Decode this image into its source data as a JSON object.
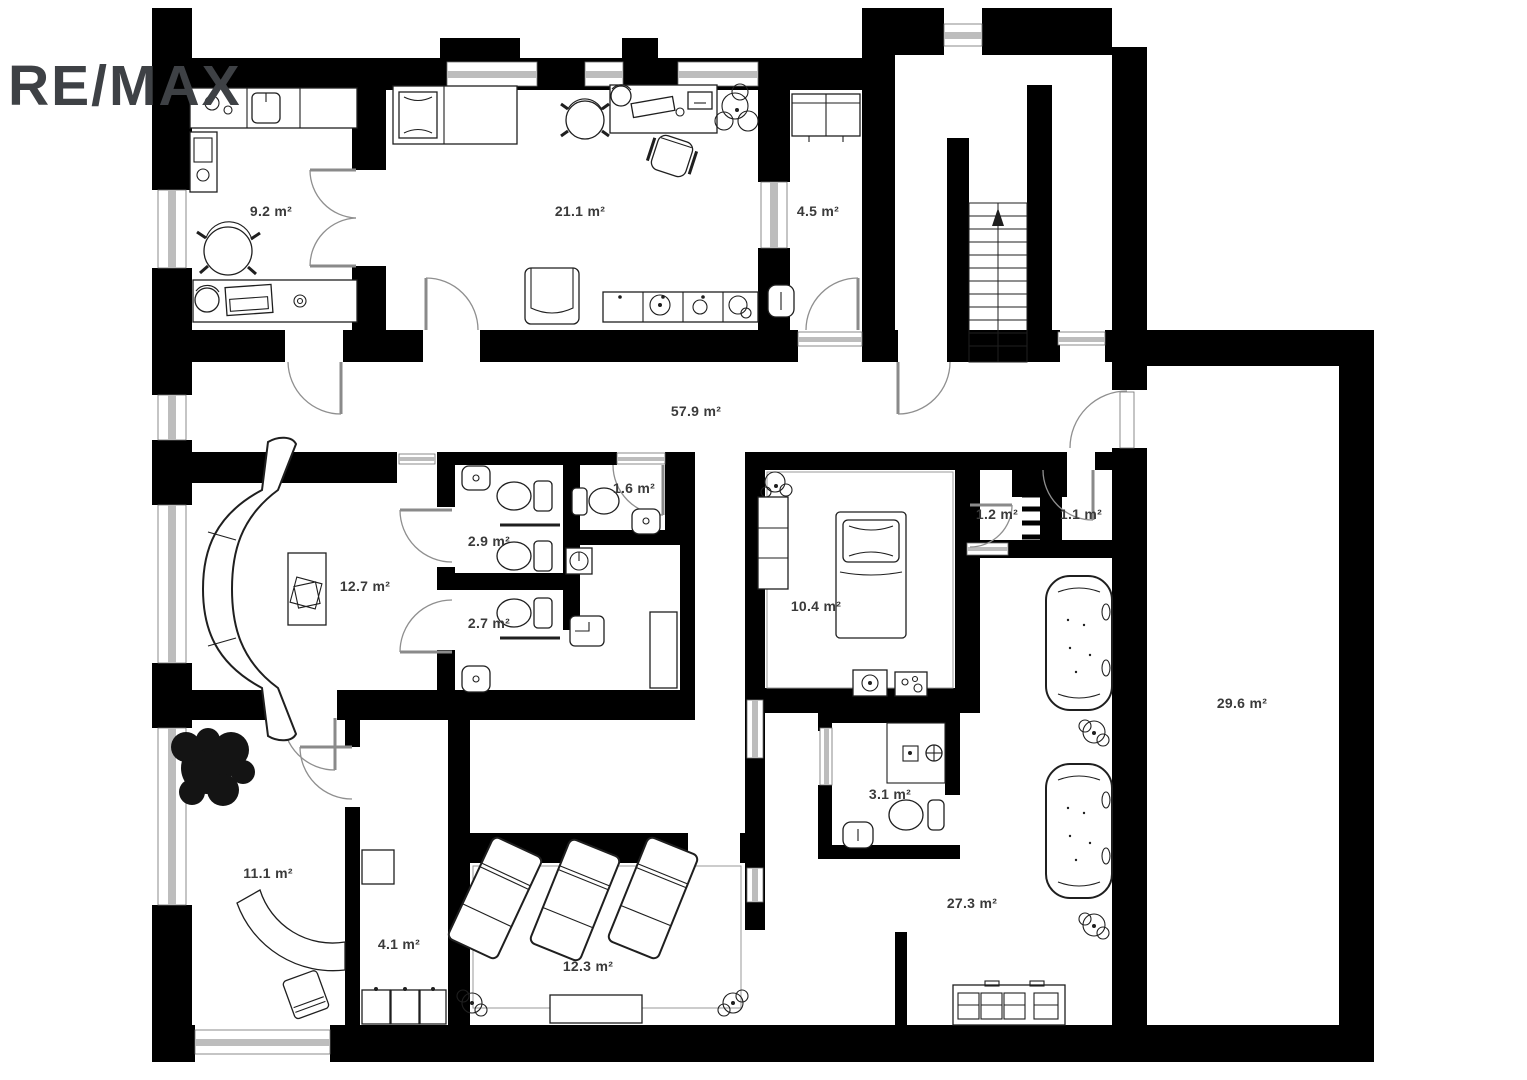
{
  "branding": {
    "logo_text": "RE/MAX",
    "logo_color": "#3e4145"
  },
  "plan": {
    "area_unit": "m²",
    "rooms": [
      {
        "name": "kitchen-office",
        "label": "9.2 m²"
      },
      {
        "name": "large-office",
        "label": "21.1 m²"
      },
      {
        "name": "wardrobe-room",
        "label": "4.5 m²"
      },
      {
        "name": "corridor",
        "label": "57.9 m²"
      },
      {
        "name": "wc-double",
        "label": "2.9 m²"
      },
      {
        "name": "wc-small",
        "label": "1.6 m²"
      },
      {
        "name": "wc-lower",
        "label": "2.7 m²"
      },
      {
        "name": "lounge-room",
        "label": "12.7 m²"
      },
      {
        "name": "bedroom",
        "label": "10.4 m²"
      },
      {
        "name": "closet-left",
        "label": "1.2 m²"
      },
      {
        "name": "closet-right",
        "label": "1.1 m²"
      },
      {
        "name": "large-empty-room",
        "label": "29.6 m²"
      },
      {
        "name": "shower-room",
        "label": "3.1 m²"
      },
      {
        "name": "reception-room",
        "label": "11.1 m²"
      },
      {
        "name": "locker-room",
        "label": "4.1 m²"
      },
      {
        "name": "relax-room",
        "label": "12.3 m²"
      },
      {
        "name": "spa-room",
        "label": "27.3 m²"
      }
    ]
  },
  "colors": {
    "wall": "#000000",
    "window": "#bdbdbd",
    "door_arc": "#8f8f8f",
    "furniture_stroke": "#1f1f1f",
    "label": "#3a3a3a",
    "background": "#ffffff"
  }
}
